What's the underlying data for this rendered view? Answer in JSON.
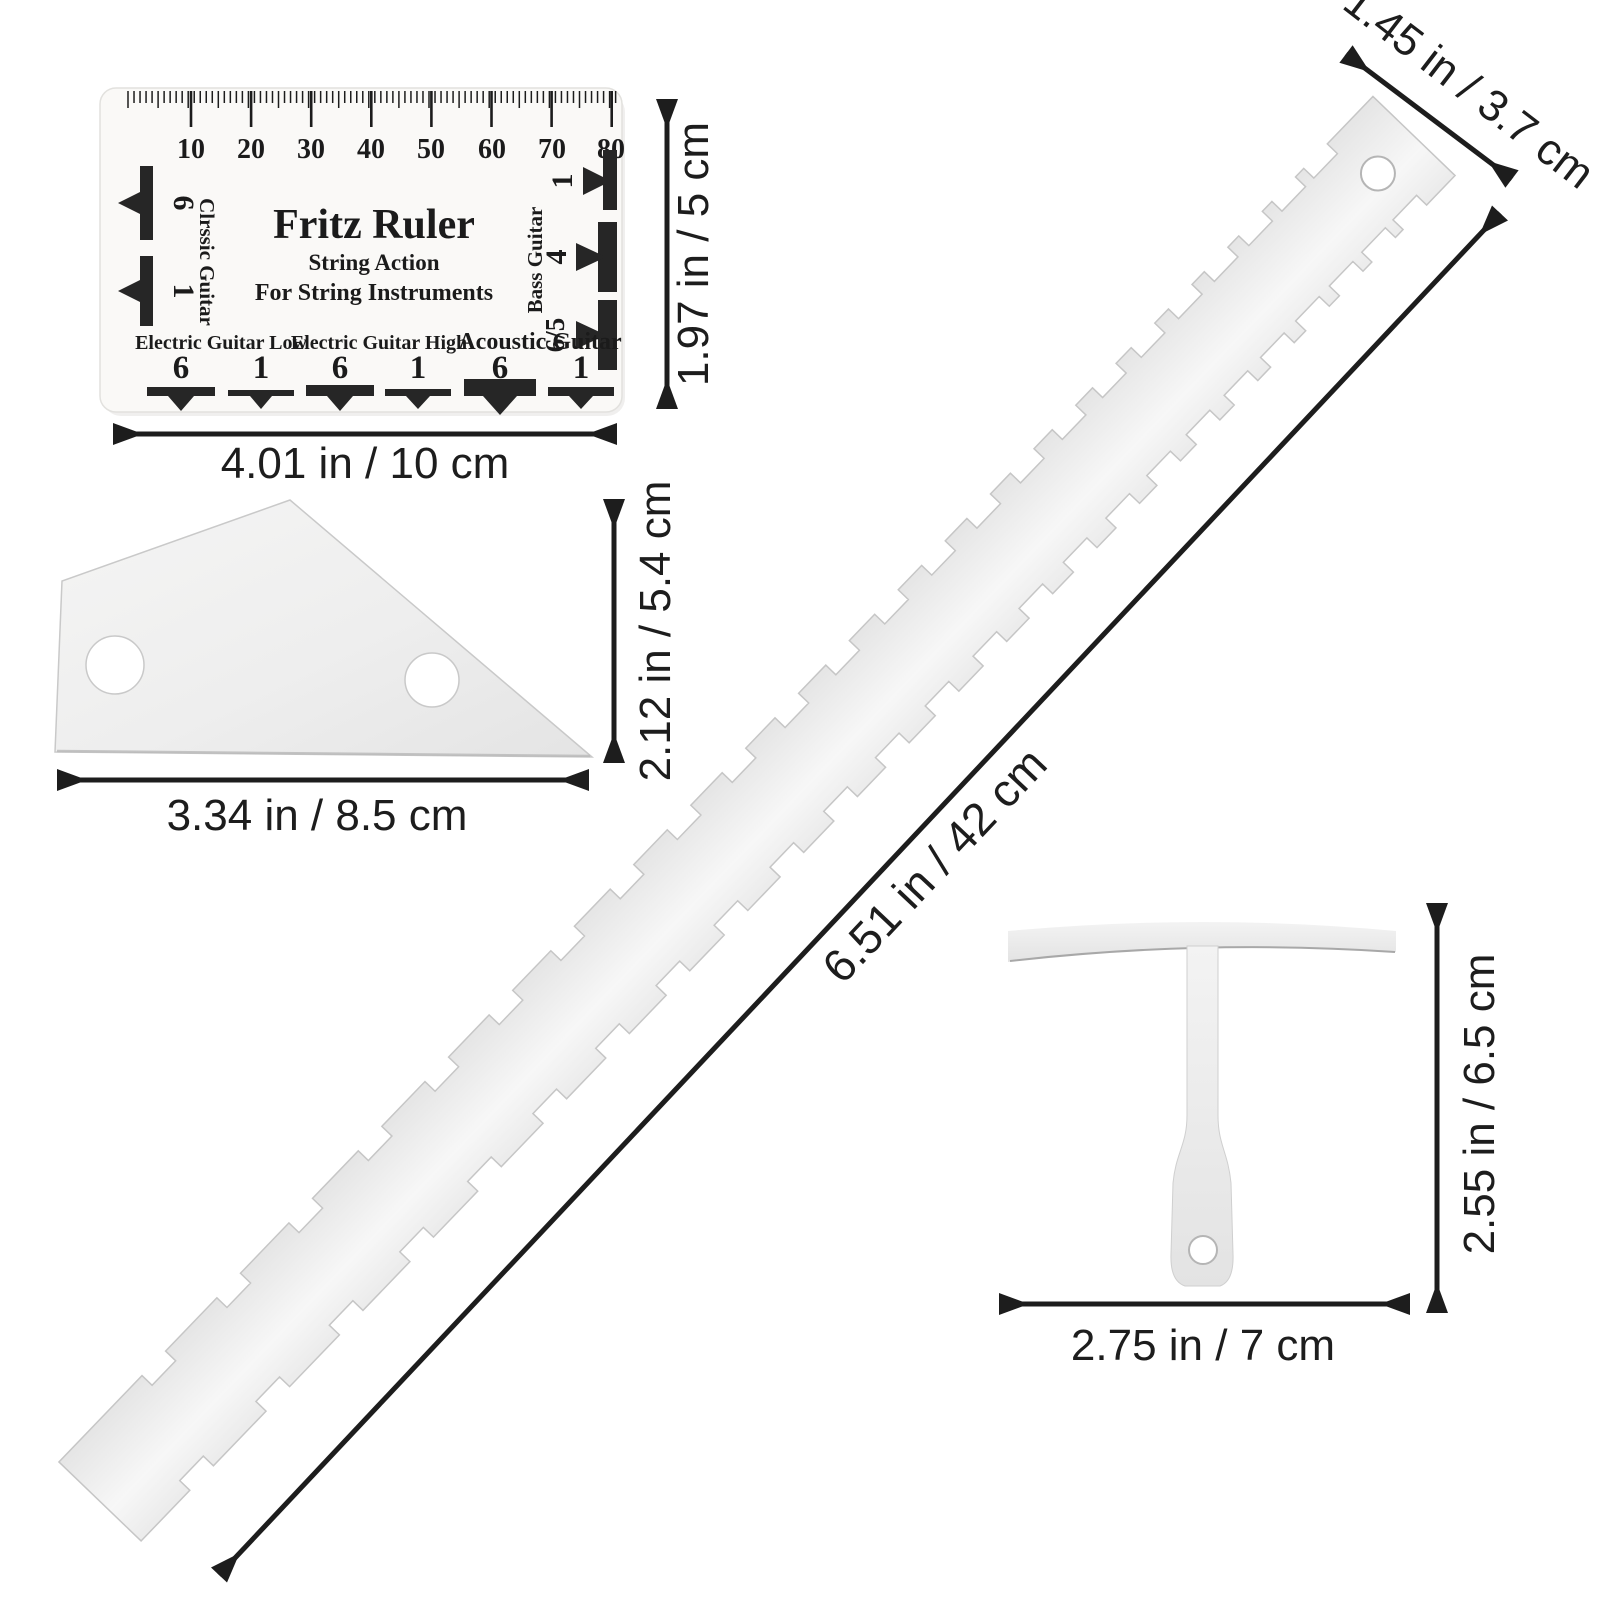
{
  "product_card": {
    "scale_numbers": [
      "10",
      "20",
      "30",
      "40",
      "50",
      "60",
      "70",
      "80"
    ],
    "title": "Fritz Ruler",
    "subtitle": "String Action",
    "subtitle2": "For String Instruments",
    "left": {
      "label": "Clrssic Guitar",
      "markers": [
        "6",
        "1"
      ]
    },
    "right": {
      "label": "Bass Guitar",
      "markers": [
        "1",
        "4",
        "6/5"
      ]
    },
    "bottom": [
      {
        "label": "Electric Guitar Low",
        "left_num": "6",
        "right_num": "1"
      },
      {
        "label": "Electric Guitar High",
        "left_num": "6",
        "right_num": "1"
      },
      {
        "label": "Acoustic Guitar",
        "left_num": "6",
        "right_num": "1"
      }
    ]
  },
  "dimensions": {
    "action_card_width": "4.01 in / 10 cm",
    "action_card_height": "1.97 in / 5 cm",
    "fret_rocker_width": "3.34 in / 8.5 cm",
    "fret_rocker_height": "2.12 in / 5.4 cm",
    "straightedge_length": "6.51 in / 42 cm",
    "straightedge_width": "1.45 in / 3.7 cm",
    "t_gauge_width": "2.75 in / 7 cm",
    "t_gauge_height": "2.55 in / 6.5 cm"
  },
  "colors": {
    "ink": "#1b1b1b",
    "dimension_ink": "#1d1d1d",
    "metal_light": "#f6f6f6",
    "metal_dark": "#e6e6e6",
    "card_background": "#faf9f7"
  }
}
